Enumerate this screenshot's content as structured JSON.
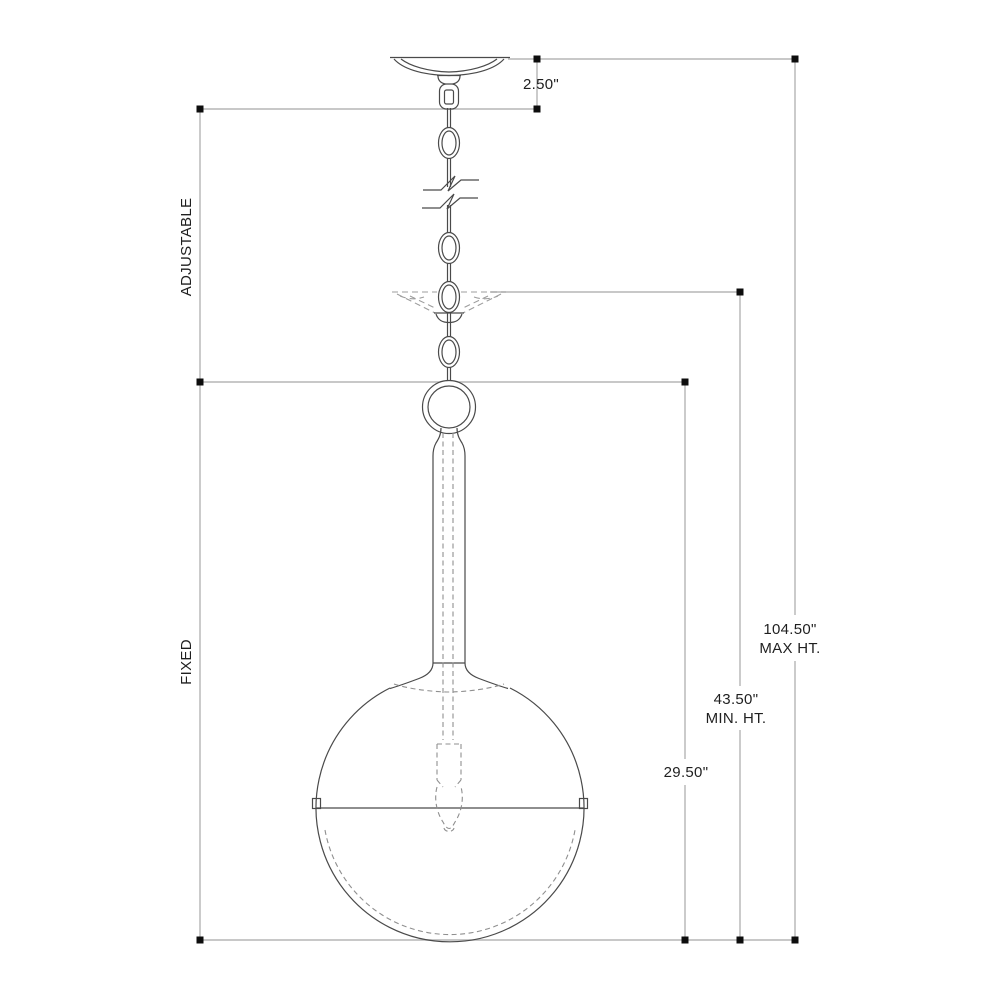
{
  "diagram": {
    "type": "technical-line-drawing",
    "subject": "globe pendant light fixture with chain suspension, dimension drawing",
    "labels": {
      "canopy_height": "2.50\"",
      "adjustable_section": "ADJUSTABLE",
      "fixed_section": "FIXED",
      "max_height_value": "104.50\"",
      "max_height_caption": "MAX HT.",
      "min_height_value": "43.50\"",
      "min_height_caption": "MIN. HT.",
      "fixture_height": "29.50\""
    },
    "colors": {
      "background": "#ffffff",
      "fixture_line": "#4a4a4a",
      "hidden_line": "#9c9c9c",
      "dimension_line": "#b5b5b5",
      "terminator_dot": "#0d0d0d",
      "text": "#1f1f1f"
    }
  }
}
